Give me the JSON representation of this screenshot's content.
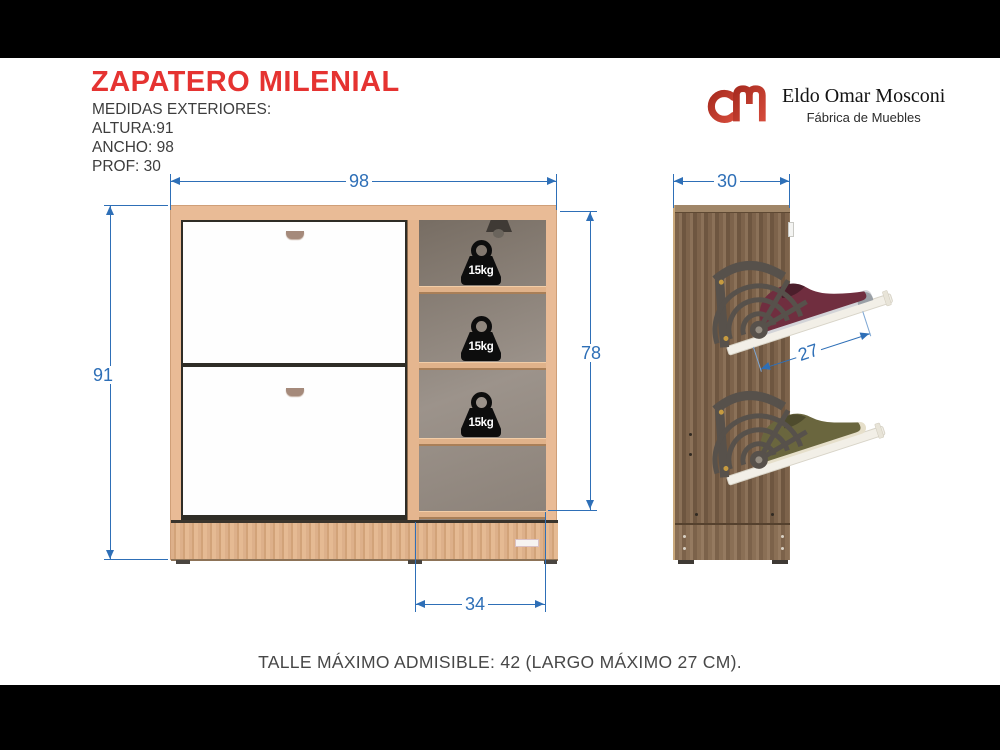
{
  "header": {
    "title": "ZAPATERO MILENIAL",
    "specs": {
      "heading": "MEDIDAS EXTERIORES:",
      "lines": [
        "ALTURA:91",
        "ANCHO: 98",
        "PROF: 30"
      ]
    }
  },
  "brand": {
    "name": "Eldo Omar Mosconi",
    "tagline": "Fábrica de Muebles",
    "logo_color": "#c23a2c"
  },
  "front_view": {
    "width_label": "98",
    "height_label": "91",
    "interior_height_label": "78",
    "shelf_width_label": "34",
    "weight_capacity": "15kg"
  },
  "side_view": {
    "depth_label": "30",
    "tray_length_label": "27"
  },
  "footer": {
    "note": "TALLE MÁXIMO ADMISIBLE: 42 (LARGO MÁXIMO 27 CM)."
  },
  "colors": {
    "title_red": "#e53331",
    "dimension_blue": "#2e6fb7",
    "front_wood": "#e9bb96",
    "side_wood": "#7d634b"
  }
}
